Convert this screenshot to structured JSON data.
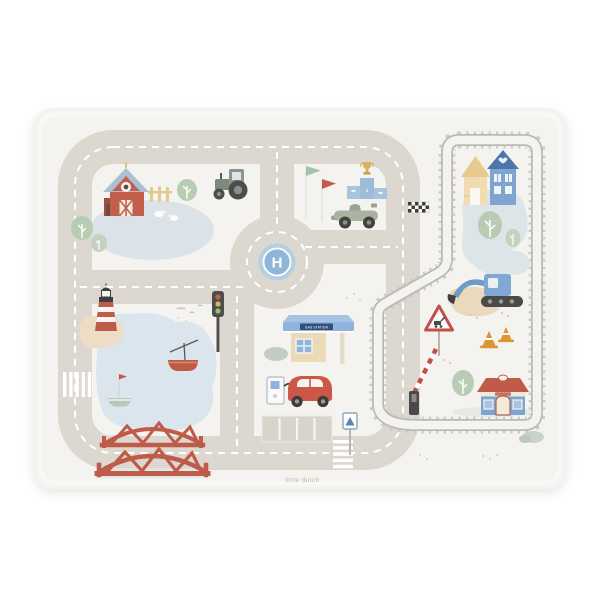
{
  "image": {
    "type": "product-photo",
    "subject": "Little Dutch children's road-map play mat / placemat on a white background"
  },
  "mat": {
    "brand_label": "little dutch",
    "roundabout": {
      "helipad_letter": "H"
    },
    "gas_station": {
      "sign_text": "GAS STATION"
    },
    "podium": {
      "rank_label": "1"
    },
    "illustrations": [
      "red barn with blue roof",
      "farm fence",
      "sheep",
      "pond",
      "trees",
      "tractor",
      "green flag",
      "red flag",
      "winners podium with trophy",
      "race car",
      "checkered finish line",
      "railway loop with ties",
      "yellow house",
      "blue house",
      "roundabout with helicopter pad",
      "excavator digging sand",
      "roadworks warning sign",
      "traffic cones",
      "train station building",
      "bush",
      "lighthouse on sand bank",
      "lake with red boat and sailboat",
      "flying birds",
      "red truss bridge",
      "traffic light",
      "gas station with canopy",
      "fuel pump",
      "red car",
      "parking spaces",
      "railway crossing barrier",
      "railway crossing sign",
      "zebra crossing left road",
      "zebra crossing bottom road"
    ],
    "colors": {
      "background": "#ffffff",
      "mat_base": "#f4f3ef",
      "road": "#dcd8cf",
      "road_marking": "#ffffff",
      "rail": "#c2c2c0",
      "water": "#dae5ee",
      "sand": "#eedcc4",
      "accent_red": "#c05a49",
      "accent_blue": "#7ea4cf",
      "helipad_blue": "#8fb6d7",
      "tree_green": "#b8cbb3",
      "accent_yellow": "#e8cf9d",
      "cone_orange": "#dd9434",
      "dark_gray": "#4a4a48"
    }
  }
}
